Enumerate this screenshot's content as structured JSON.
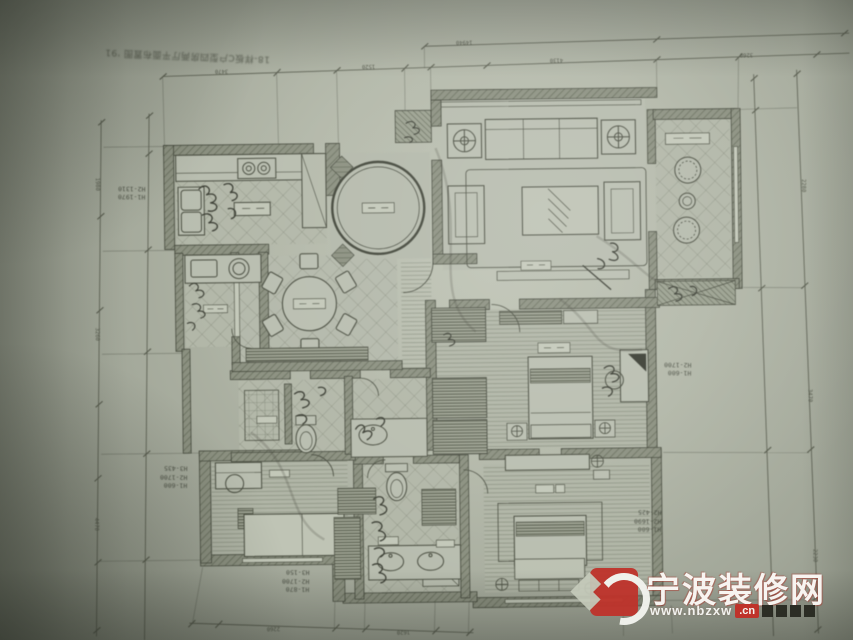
{
  "corner_note": "18-样板C户型四房两厅平面布置图 '91",
  "annotations": {
    "left_top": [
      "H1-1970",
      "H2-1310"
    ],
    "left_mid": [
      "H1-600",
      "H2-1700",
      "H3-435"
    ],
    "bottom_left": [
      "H1-870",
      "H2-1700",
      "H3-150"
    ],
    "right_mid": [
      "H1-600",
      "H2-1700"
    ],
    "right_bottom": [
      "H1-600",
      "H2-1690",
      "H2-425"
    ]
  },
  "dims": {
    "top_outer": [
      "14940"
    ],
    "top_inner": [
      "3470",
      "1520",
      "4130",
      "3260"
    ],
    "left": [
      "1980",
      "3260",
      "4470"
    ],
    "right": [
      "2280",
      "3470",
      "2230"
    ],
    "bottom": [
      "2260",
      "1620"
    ]
  },
  "watermark": {
    "site_name": "宁波装修网",
    "url": "www.nbzxw",
    "url_suffix": ".cn",
    "accent_color": "#bf332b",
    "blocks": 4
  },
  "rooms": [
    {
      "id": "kitchen",
      "features": "L-counter, double sink, 2-burner stove"
    },
    {
      "id": "bath-1",
      "features": "vanity with square sink and round basin"
    },
    {
      "id": "dining",
      "features": "round table, 6 chairs, sideboard"
    },
    {
      "id": "foyer",
      "features": "circular ceiling feature"
    },
    {
      "id": "living",
      "features": "sofa, 2 armchairs, lamp tables, coffee table, TV cabinet"
    },
    {
      "id": "leisure-balcony",
      "features": "2 rattan chairs, round tea table, a/c platform"
    },
    {
      "id": "bedroom-mid",
      "features": "double bed, nightstands, desk, hall wardrobes"
    },
    {
      "id": "bath-2",
      "features": "shower, toilet, basin"
    },
    {
      "id": "bedroom-left",
      "features": "desk, chair, bed"
    },
    {
      "id": "bath-3",
      "features": "toilet, double vanity, wardrobes"
    },
    {
      "id": "bedroom-bottom-right",
      "features": "bed, bench, nightstands, dresser"
    }
  ]
}
